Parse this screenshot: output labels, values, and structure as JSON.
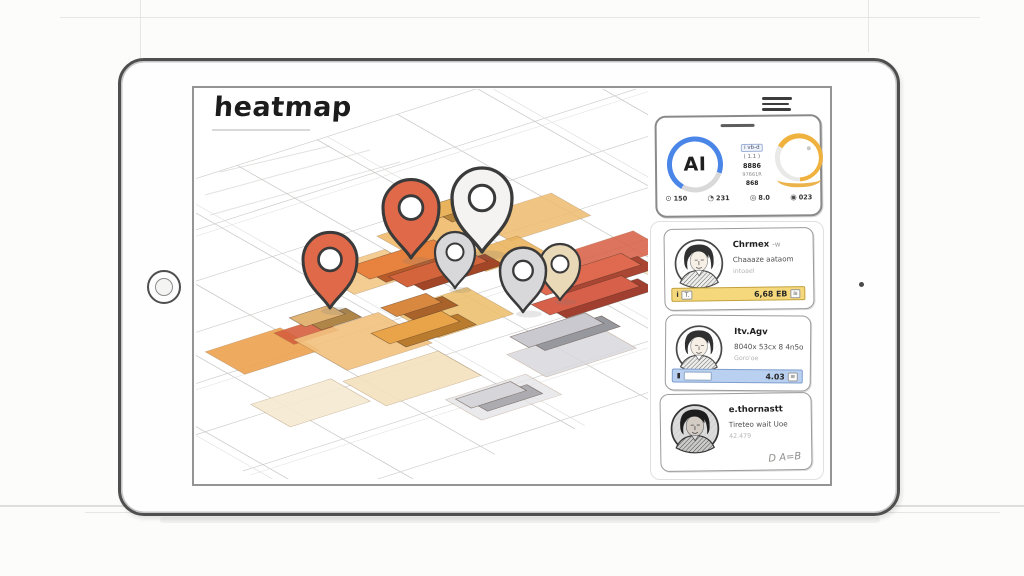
{
  "title": "heatmap",
  "menu": {
    "icon": "hamburger"
  },
  "ai_panel": {
    "badge": "AI",
    "readout": [
      "i vb-d",
      "( 1.1 )",
      "8886",
      "97661R",
      "868"
    ],
    "stats": [
      {
        "icon": "dial-icon",
        "glyph": "⊙",
        "value": "150"
      },
      {
        "icon": "clock-icon",
        "glyph": "◔",
        "value": "231"
      },
      {
        "icon": "gauge-icon",
        "glyph": "◎",
        "value": "8.0"
      },
      {
        "icon": "globe-icon",
        "glyph": "◉",
        "value": "023"
      }
    ]
  },
  "cards": [
    {
      "title": "Chrmex",
      "title_suffix": "-w",
      "line2": "Chaaaze aataom",
      "line3": "intoael",
      "bar_icon": "i",
      "bar_tag": "T.",
      "metric": "6,68 EB",
      "metric_tag": "≋",
      "bar_style": "yellow"
    },
    {
      "title": "Itv.Agv",
      "title_suffix": "",
      "line2": "8040x 53cx 8 4n5o",
      "line3": "Goro'oe",
      "bar_icon": "�governs",
      "metric": "4.03",
      "metric_tag": "≋",
      "bar_style": "blue"
    },
    {
      "title": "e.thornastt",
      "title_suffix": "",
      "line2": "Tireteo wait Uoe",
      "line3": "42.479",
      "signature": "D A=B",
      "bar_style": "none"
    }
  ],
  "map": {
    "pins": [
      {
        "name": "pin-orange-1",
        "color": "#e0694a"
      },
      {
        "name": "pin-orange-2",
        "color": "#e0694a"
      },
      {
        "name": "pin-white",
        "color": "#f4f3f1"
      },
      {
        "name": "pin-gray-1",
        "color": "#d8d8db"
      },
      {
        "name": "pin-gray-2",
        "color": "#d8d8db"
      },
      {
        "name": "pin-tan",
        "color": "#e9d9b6"
      }
    ]
  },
  "colors": {
    "accent_blue": "#4a86e8",
    "accent_orange": "#f0b23f",
    "bar_yellow": "#f5d87b",
    "bar_blue": "#b9d0f1",
    "pin_orange": "#e0694a",
    "heat_red": "#d96248",
    "heat_amber": "#f2c27e"
  }
}
